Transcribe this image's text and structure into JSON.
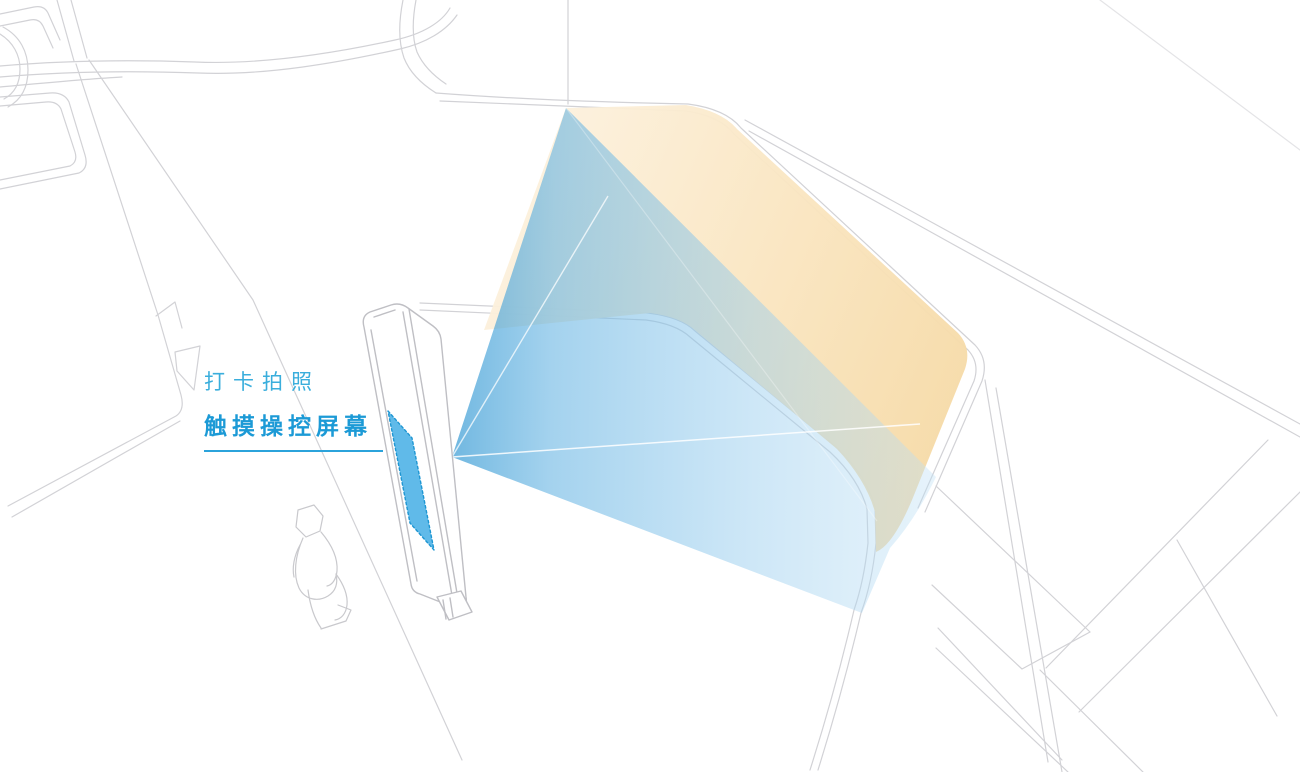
{
  "diagram": {
    "title": "interactive kiosk projection diagram",
    "annotation": {
      "line1": "打卡拍照",
      "line2": "触摸操控屏幕"
    },
    "colors": {
      "label_blue_light": "#3AAEDC",
      "label_blue_bold": "#1C9AD6",
      "underline_blue": "#2BA3DB",
      "beam_blue_strong": "#4FA8DF",
      "beam_blue_pale": "#CDE7F7",
      "beam_orange_pale": "#FBEDD6",
      "beam_orange_deep": "#F5D8A2",
      "overlap_green": "#CFE0CC",
      "screen_fill_blue": "#4AB0E6",
      "screen_border_blue": "#1E96D2",
      "wireframe_gray": "#D2D2D6",
      "kiosk_outline_gray": "#BFBFC4"
    },
    "elements": {
      "background": "site-plan-wireframe",
      "kiosk": "touchscreen-kiosk",
      "screen": "touch-screen",
      "person": "person-figure",
      "blue_beam": "screen-projection-beam",
      "orange_beam": "wall-projection-beam"
    }
  }
}
